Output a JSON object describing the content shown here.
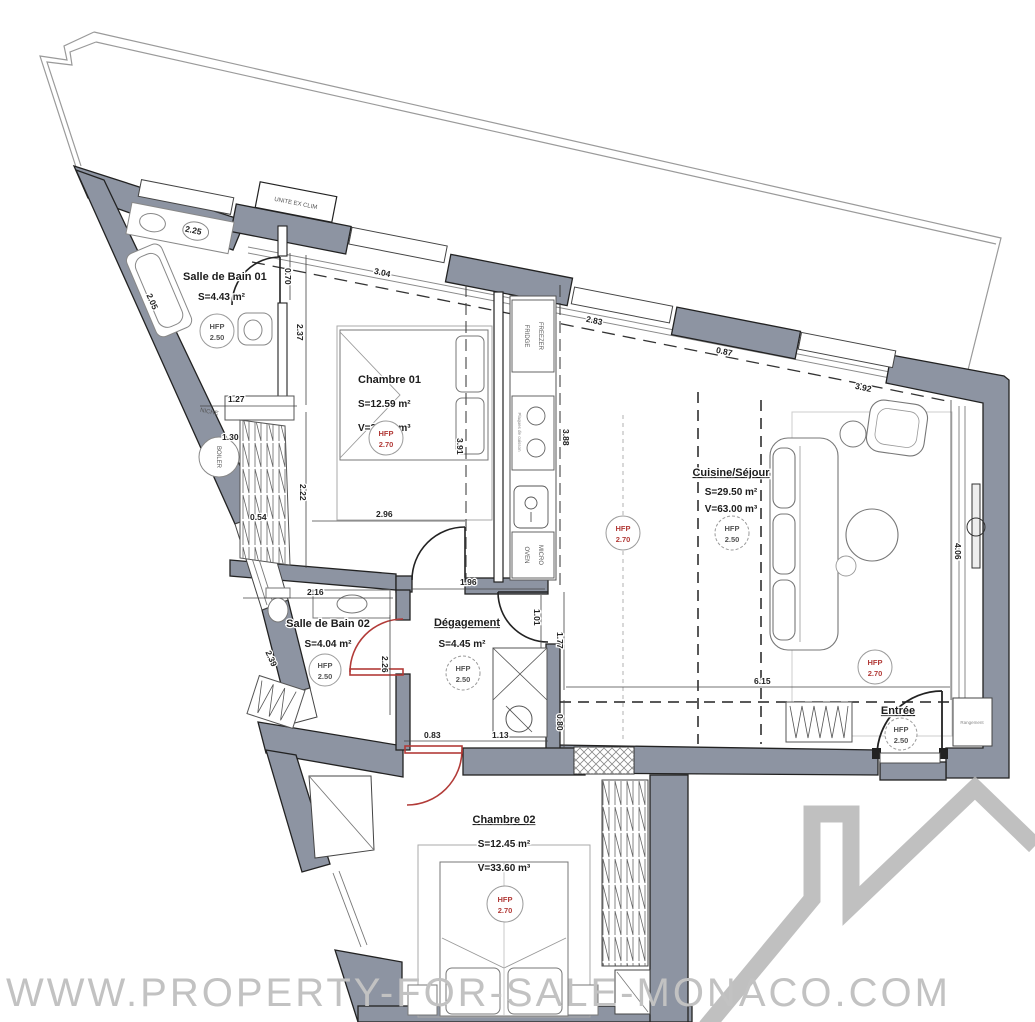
{
  "watermark": "WWW.PROPERTY-FOR-SALE-MONACO.COM",
  "hfp_label": "HFP",
  "colors": {
    "wall": "#8d94a2",
    "red_accent": "#b23b38",
    "line": "#2b2b2b",
    "watermark_gray": "#c2c2c2",
    "logo_gray": "#b5b5b5"
  },
  "rooms": {
    "sdb01": {
      "name": "Salle de Bain 01",
      "area": "S=4.43 m²",
      "hfp_value": "2.50"
    },
    "chambre01": {
      "name": "Chambre 01",
      "area": "S=12.59 m²",
      "volume": "V=34.00 m³",
      "hfp_value": "2.70"
    },
    "cuisine": {
      "name": "Cuisine/Séjour",
      "area": "S=29.50 m²",
      "volume": "V=63.00 m³",
      "hfp_value": "2.50",
      "hfp_value2": "2.70"
    },
    "sdb02": {
      "name": "Salle de Bain 02",
      "area": "S=4.04 m²",
      "hfp_value": "2.50"
    },
    "degagement": {
      "name": "Dégagement",
      "area": "S=4.45 m²",
      "hfp_value": "2.50"
    },
    "entree": {
      "name": "Entrée",
      "hfp_value": "2.50"
    },
    "chambre02": {
      "name": "Chambre 02",
      "area": "S=12.45 m²",
      "volume": "V=33.60 m³",
      "hfp_value": "2.70"
    }
  },
  "annotations": {
    "unite_ex_clim": "UNITE EX CLIM",
    "niche": "NICHE",
    "boiler": "BOILER",
    "fridge": "FRIDGE",
    "freezer": "FREEZER",
    "plaques": "Plaques de cuisson",
    "oven": "OVEN",
    "micro": "MICRO",
    "rangement": "Rangement"
  },
  "dims": {
    "v225": "2.25",
    "v070": "0.70",
    "v237": "2.37",
    "v304": "3.04",
    "v205": "2.05",
    "v127": "1.27",
    "v130": "1.30",
    "v054": "0.54",
    "v222": "2.22",
    "v296": "2.96",
    "v391": "3.91",
    "v388": "3.88",
    "v283": "2.83",
    "v087": "0.87",
    "v392": "3.92",
    "v196": "1.96",
    "v216": "2.16",
    "v101": "1.01",
    "v177": "1.77",
    "v226": "2.26",
    "v239": "2.39",
    "v083": "0.83",
    "v113": "1.13",
    "v080": "0.80",
    "v615": "6.15",
    "v406": "4.06"
  }
}
